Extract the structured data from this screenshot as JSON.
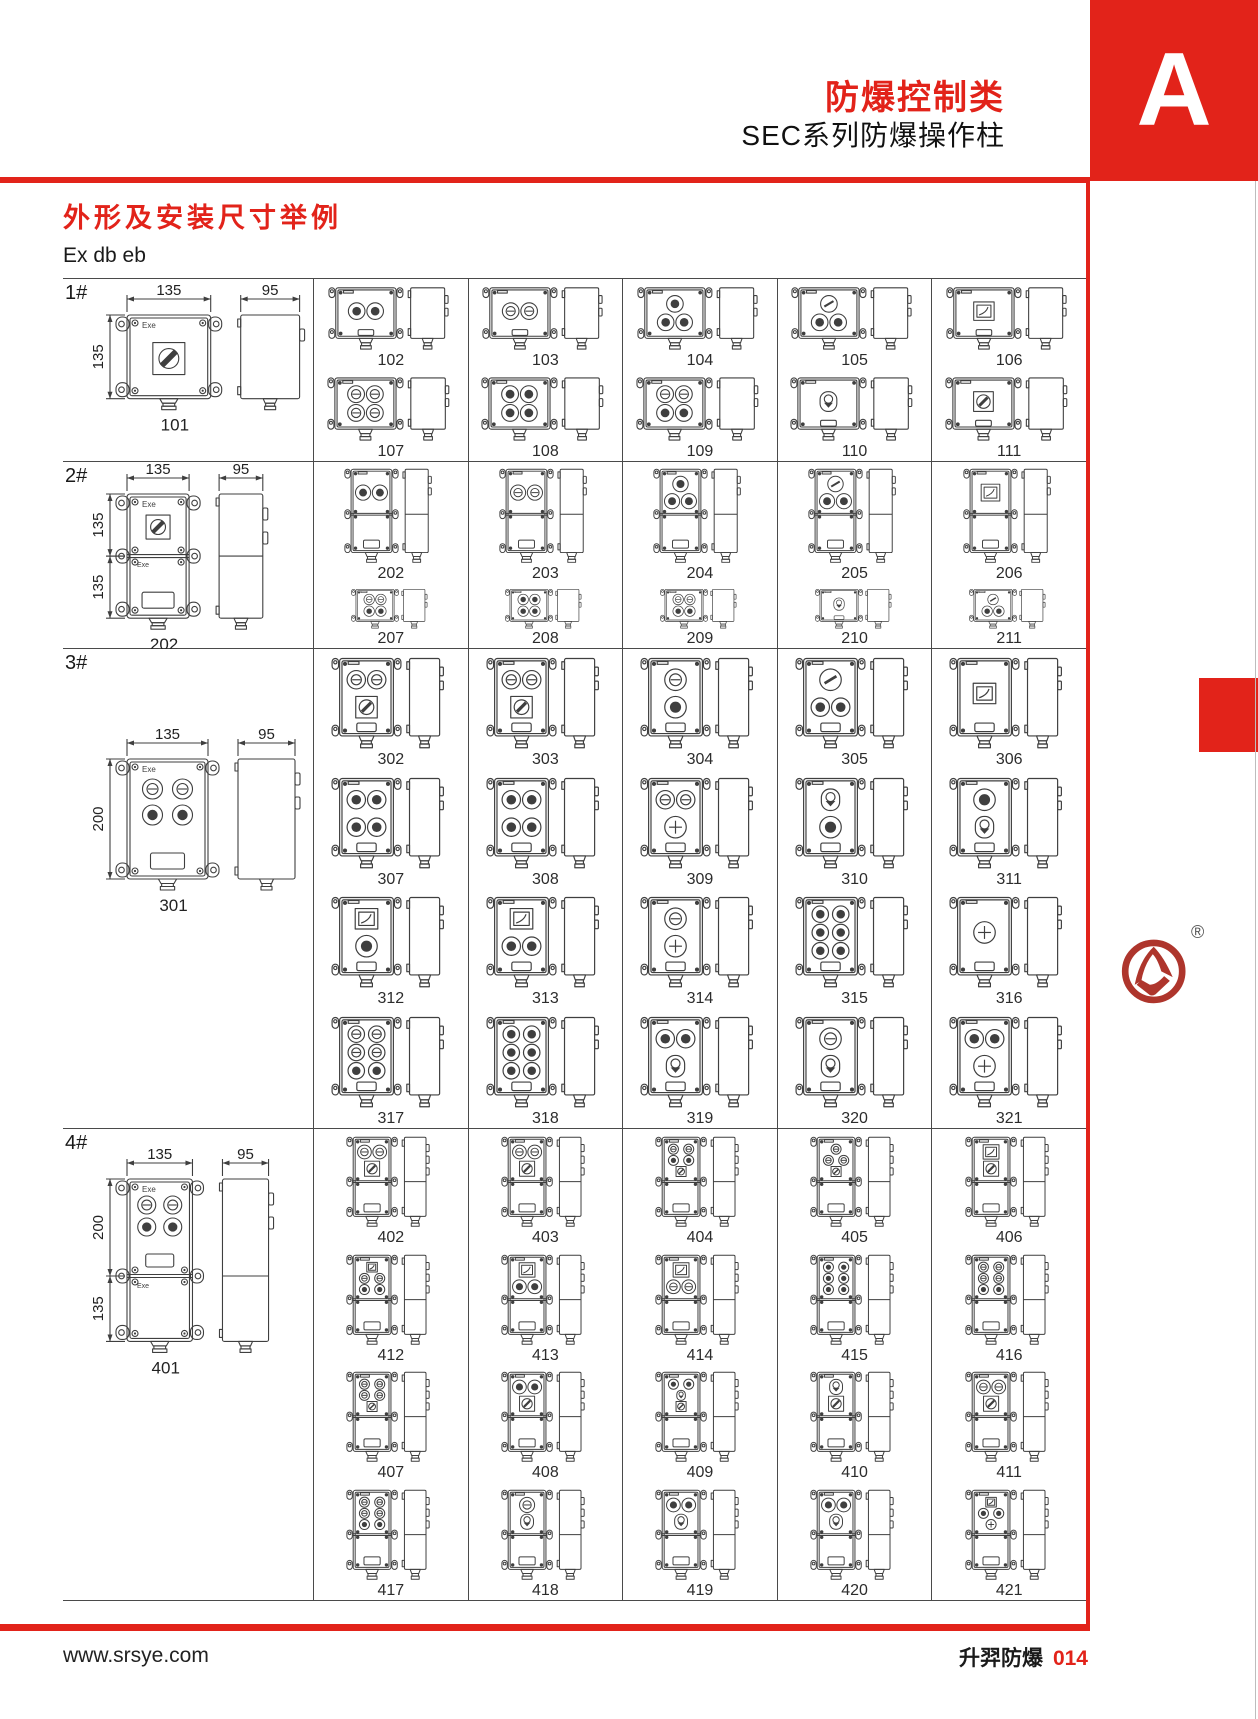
{
  "header": {
    "category": "防爆控制类",
    "series": "SEC系列防爆操作柱",
    "section_letter": "A"
  },
  "section": {
    "title": "外形及安装尺寸举例",
    "protection": "Ex db eb"
  },
  "footer": {
    "website": "www.srsye.com",
    "brand": "升羿防爆",
    "page_number": "014"
  },
  "logo": {
    "registered_mark": "®"
  },
  "colors": {
    "accent_red": "#e2231a",
    "logo_red": "#ae352c",
    "grid_line": "#4a4a4a",
    "drawing_stroke": "#3f3f3f",
    "text": "#1c1c1c"
  },
  "control_codes": {
    "b": "push-button",
    "l": "indicator-lamp",
    "k": "rotary-switch",
    "m": "meter",
    "j": "joystick-switch",
    "x": "emergency-button",
    "s": "selector-switch",
    "K": "main-rotary-switch"
  },
  "table": {
    "sections": [
      {
        "label": "1#",
        "height": 183,
        "main": {
          "number": "101",
          "dim_width": "135",
          "dim_depth": "95",
          "dim_heights": [
            "135"
          ],
          "exe_label": "Exe"
        },
        "rows": [
          {
            "h": 91,
            "shape": "sq",
            "cells": [
              {
                "number": "102",
                "controls": [
                  [
                    "b",
                    "b"
                  ]
                ]
              },
              {
                "number": "103",
                "controls": [
                  [
                    "l",
                    "l"
                  ]
                ]
              },
              {
                "number": "104",
                "controls": [
                  [
                    "b"
                  ],
                  [
                    "b",
                    "b"
                  ]
                ]
              },
              {
                "number": "105",
                "controls": [
                  [
                    "s"
                  ],
                  [
                    "b",
                    "b"
                  ]
                ]
              },
              {
                "number": "106",
                "controls": [
                  [
                    "m"
                  ]
                ]
              }
            ]
          },
          {
            "h": 92,
            "shape": "sq",
            "cells": [
              {
                "number": "107",
                "controls": [
                  [
                    "l",
                    "l"
                  ],
                  [
                    "l",
                    "l"
                  ]
                ]
              },
              {
                "number": "108",
                "controls": [
                  [
                    "b",
                    "b"
                  ],
                  [
                    "b",
                    "b"
                  ]
                ]
              },
              {
                "number": "109",
                "controls": [
                  [
                    "l",
                    "l"
                  ],
                  [
                    "b",
                    "b"
                  ]
                ]
              },
              {
                "number": "110",
                "controls": [
                  [
                    "j"
                  ]
                ]
              },
              {
                "number": "111",
                "controls": [
                  [
                    "k"
                  ]
                ]
              }
            ]
          }
        ]
      },
      {
        "label": "2#",
        "height": 187,
        "main": {
          "number": "202",
          "dim_width": "135",
          "dim_depth": "95",
          "dim_heights": [
            "135",
            "135"
          ],
          "exe_label": "Exe"
        },
        "rows": [
          {
            "h": 122,
            "shape": "tall2",
            "cells": [
              {
                "number": "202",
                "controls": [
                  [
                    "b",
                    "b"
                  ]
                ]
              },
              {
                "number": "203",
                "controls": [
                  [
                    "l",
                    "l"
                  ]
                ]
              },
              {
                "number": "204",
                "controls": [
                  [
                    "b"
                  ],
                  [
                    "b",
                    "b"
                  ]
                ]
              },
              {
                "number": "205",
                "controls": [
                  [
                    "s"
                  ],
                  [
                    "b",
                    "b"
                  ]
                ]
              },
              {
                "number": "206",
                "controls": [
                  [
                    "m"
                  ]
                ]
              }
            ]
          },
          {
            "h": 65,
            "shape": "sq",
            "cells": [
              {
                "number": "207",
                "controls": [
                  [
                    "l",
                    "l"
                  ],
                  [
                    "b",
                    "b"
                  ]
                ]
              },
              {
                "number": "208",
                "controls": [
                  [
                    "b",
                    "b"
                  ],
                  [
                    "b",
                    "b"
                  ]
                ]
              },
              {
                "number": "209",
                "controls": [
                  [
                    "l",
                    "l"
                  ],
                  [
                    "b",
                    "b"
                  ]
                ]
              },
              {
                "number": "210",
                "controls": [
                  [
                    "j"
                  ]
                ]
              },
              {
                "number": "211",
                "controls": [
                  [
                    "s"
                  ],
                  [
                    "b",
                    "b"
                  ]
                ]
              }
            ]
          }
        ]
      },
      {
        "label": "3#",
        "height": 480,
        "main": {
          "number": "301",
          "dim_width": "135",
          "dim_depth": "95",
          "dim_heights": [
            "200"
          ],
          "exe_label": "Exe"
        },
        "rows": [
          {
            "h": 120,
            "shape": "v200",
            "cells": [
              {
                "number": "302",
                "controls": [
                  [
                    "l",
                    "l"
                  ],
                  [
                    "k"
                  ]
                ]
              },
              {
                "number": "303",
                "controls": [
                  [
                    "l",
                    "l"
                  ],
                  [
                    "k"
                  ]
                ]
              },
              {
                "number": "304",
                "controls": [
                  [
                    "l"
                  ],
                  [
                    "b"
                  ]
                ]
              },
              {
                "number": "305",
                "controls": [
                  [
                    "s"
                  ],
                  [
                    "b",
                    "b"
                  ]
                ]
              },
              {
                "number": "306",
                "controls": [
                  [
                    "m"
                  ]
                ]
              }
            ]
          },
          {
            "h": 120,
            "shape": "v200",
            "cells": [
              {
                "number": "307",
                "controls": [
                  [
                    "b",
                    "b"
                  ],
                  [
                    "b",
                    "b"
                  ]
                ]
              },
              {
                "number": "308",
                "controls": [
                  [
                    "b",
                    "b"
                  ],
                  [
                    "b",
                    "b"
                  ]
                ]
              },
              {
                "number": "309",
                "controls": [
                  [
                    "l",
                    "l"
                  ],
                  [
                    "x"
                  ]
                ]
              },
              {
                "number": "310",
                "controls": [
                  [
                    "j"
                  ],
                  [
                    "b"
                  ]
                ]
              },
              {
                "number": "311",
                "controls": [
                  [
                    "b"
                  ],
                  [
                    "j"
                  ]
                ]
              }
            ]
          },
          {
            "h": 120,
            "shape": "v200",
            "cells": [
              {
                "number": "312",
                "controls": [
                  [
                    "m"
                  ],
                  [
                    "b"
                  ]
                ]
              },
              {
                "number": "313",
                "controls": [
                  [
                    "m"
                  ],
                  [
                    "b",
                    "b"
                  ]
                ]
              },
              {
                "number": "314",
                "controls": [
                  [
                    "l"
                  ],
                  [
                    "x"
                  ]
                ]
              },
              {
                "number": "315",
                "controls": [
                  [
                    "b",
                    "b"
                  ],
                  [
                    "b",
                    "b"
                  ],
                  [
                    "b",
                    "b"
                  ]
                ]
              },
              {
                "number": "316",
                "controls": [
                  [
                    "x"
                  ]
                ]
              }
            ]
          },
          {
            "h": 120,
            "shape": "v200",
            "cells": [
              {
                "number": "317",
                "controls": [
                  [
                    "l",
                    "l"
                  ],
                  [
                    "l",
                    "l"
                  ],
                  [
                    "b",
                    "b"
                  ]
                ]
              },
              {
                "number": "318",
                "controls": [
                  [
                    "b",
                    "b"
                  ],
                  [
                    "b",
                    "b"
                  ],
                  [
                    "b",
                    "b"
                  ]
                ]
              },
              {
                "number": "319",
                "controls": [
                  [
                    "b",
                    "b"
                  ],
                  [
                    "j"
                  ]
                ]
              },
              {
                "number": "320",
                "controls": [
                  [
                    "l"
                  ],
                  [
                    "j"
                  ]
                ]
              },
              {
                "number": "321",
                "controls": [
                  [
                    "b",
                    "b"
                  ],
                  [
                    "x"
                  ]
                ]
              }
            ]
          }
        ]
      },
      {
        "label": "4#",
        "height": 472,
        "main": {
          "number": "401",
          "dim_width": "135",
          "dim_depth": "95",
          "dim_heights": [
            "200",
            "135"
          ],
          "exe_label": "Exe"
        },
        "rows": [
          {
            "h": 118,
            "shape": "tall2b",
            "cells": [
              {
                "number": "402",
                "controls": [
                  [
                    "l",
                    "l"
                  ],
                  [
                    "k"
                  ]
                ]
              },
              {
                "number": "403",
                "controls": [
                  [
                    "l",
                    "l"
                  ],
                  [
                    "k"
                  ]
                ]
              },
              {
                "number": "404",
                "controls": [
                  [
                    "l",
                    "l"
                  ],
                  [
                    "b",
                    "b"
                  ],
                  [
                    "k"
                  ]
                ]
              },
              {
                "number": "405",
                "controls": [
                  [
                    "l"
                  ],
                  [
                    "l",
                    "l"
                  ],
                  [
                    "k"
                  ]
                ]
              },
              {
                "number": "406",
                "controls": [
                  [
                    "m"
                  ],
                  [
                    "k"
                  ]
                ]
              }
            ]
          },
          {
            "h": 118,
            "shape": "tall2b",
            "cells": [
              {
                "number": "412",
                "controls": [
                  [
                    "m"
                  ],
                  [
                    "l",
                    "l"
                  ],
                  [
                    "b",
                    "b"
                  ]
                ]
              },
              {
                "number": "413",
                "controls": [
                  [
                    "m"
                  ],
                  [
                    "b",
                    "b"
                  ]
                ]
              },
              {
                "number": "414",
                "controls": [
                  [
                    "m"
                  ],
                  [
                    "l",
                    "l"
                  ]
                ]
              },
              {
                "number": "415",
                "controls": [
                  [
                    "b",
                    "b"
                  ],
                  [
                    "b",
                    "b"
                  ],
                  [
                    "b",
                    "b"
                  ]
                ]
              },
              {
                "number": "416",
                "controls": [
                  [
                    "l",
                    "l"
                  ],
                  [
                    "l",
                    "l"
                  ],
                  [
                    "b",
                    "b"
                  ]
                ]
              }
            ]
          },
          {
            "h": 118,
            "shape": "tall2b",
            "cells": [
              {
                "number": "407",
                "controls": [
                  [
                    "l",
                    "l"
                  ],
                  [
                    "l",
                    "l"
                  ],
                  [
                    "k"
                  ]
                ]
              },
              {
                "number": "408",
                "controls": [
                  [
                    "b",
                    "b"
                  ],
                  [
                    "k"
                  ]
                ]
              },
              {
                "number": "409",
                "controls": [
                  [
                    "b",
                    "b"
                  ],
                  [
                    "j"
                  ],
                  [
                    "k"
                  ]
                ]
              },
              {
                "number": "410",
                "controls": [
                  [
                    "j"
                  ],
                  [
                    "k"
                  ]
                ]
              },
              {
                "number": "411",
                "controls": [
                  [
                    "l",
                    "l"
                  ],
                  [
                    "k"
                  ]
                ]
              }
            ]
          },
          {
            "h": 118,
            "shape": "tall2b",
            "cells": [
              {
                "number": "417",
                "controls": [
                  [
                    "l",
                    "l"
                  ],
                  [
                    "l",
                    "l"
                  ],
                  [
                    "b",
                    "b"
                  ]
                ]
              },
              {
                "number": "418",
                "controls": [
                  [
                    "l"
                  ],
                  [
                    "j"
                  ]
                ]
              },
              {
                "number": "419",
                "controls": [
                  [
                    "b",
                    "b"
                  ],
                  [
                    "j"
                  ]
                ]
              },
              {
                "number": "420",
                "controls": [
                  [
                    "b",
                    "b"
                  ],
                  [
                    "j"
                  ]
                ]
              },
              {
                "number": "421",
                "controls": [
                  [
                    "m"
                  ],
                  [
                    "b",
                    "b"
                  ],
                  [
                    "x"
                  ]
                ]
              }
            ]
          }
        ]
      }
    ]
  }
}
